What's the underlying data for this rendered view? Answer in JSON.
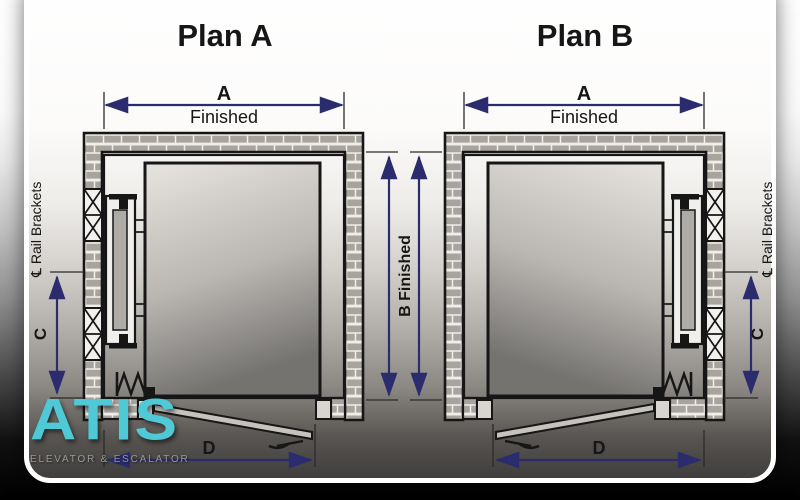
{
  "plan_a": {
    "title": "Plan A",
    "dim_width_letter": "A",
    "dim_width_sub": "Finished",
    "dim_rail_letter": "C",
    "dim_door_letter": "D",
    "rail_brackets_label": "℄ Rail Brackets"
  },
  "plan_b": {
    "title": "Plan B",
    "dim_width_letter": "A",
    "dim_width_sub": "Finished",
    "dim_rail_letter": "C",
    "dim_door_letter": "D",
    "rail_brackets_label": "℄ Rail Brackets"
  },
  "shared": {
    "dim_depth_label": "B Finished"
  },
  "logo": {
    "name": "ATIS",
    "tagline": "ELEVATOR & ESCALATOR"
  },
  "colors": {
    "dimension_arrow": "#2a2c6e",
    "drawing_line": "#161616",
    "wall_brick": "#a8a49d",
    "logo_cyan": "#4fc9d6",
    "card_border": "#ffffff"
  }
}
